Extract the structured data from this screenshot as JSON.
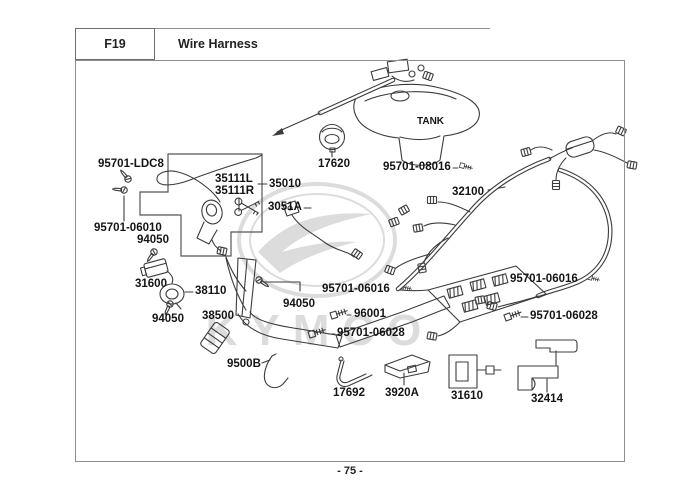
{
  "header": {
    "code": "F19",
    "title": "Wire Harness"
  },
  "footer": {
    "page_number": "- 75 -"
  },
  "watermark": {
    "brand": "KYMCO"
  },
  "diagram": {
    "tank_label": "TANK",
    "part_labels": [
      {
        "text": "95701-LDC8",
        "x": 98,
        "y": 159
      },
      {
        "text": "35111L",
        "x": 215,
        "y": 174
      },
      {
        "text": "35111R",
        "x": 215,
        "y": 186
      },
      {
        "text": "35010",
        "x": 269,
        "y": 179
      },
      {
        "text": "3051A",
        "x": 268,
        "y": 202
      },
      {
        "text": "17620",
        "x": 318,
        "y": 159
      },
      {
        "text": "95701-08016",
        "x": 383,
        "y": 162
      },
      {
        "text": "32100",
        "x": 452,
        "y": 187
      },
      {
        "text": "95701-06010",
        "x": 94,
        "y": 223
      },
      {
        "text": "94050",
        "x": 137,
        "y": 235
      },
      {
        "text": "31600",
        "x": 135,
        "y": 279
      },
      {
        "text": "38110",
        "x": 195,
        "y": 286
      },
      {
        "text": "94050",
        "x": 152,
        "y": 314
      },
      {
        "text": "38500",
        "x": 202,
        "y": 311
      },
      {
        "text": "9500B",
        "x": 227,
        "y": 359
      },
      {
        "text": "94050",
        "x": 283,
        "y": 299
      },
      {
        "text": "95701-06016",
        "x": 322,
        "y": 284
      },
      {
        "text": "96001",
        "x": 354,
        "y": 309
      },
      {
        "text": "95701-06028",
        "x": 337,
        "y": 328
      },
      {
        "text": "95701-06016",
        "x": 510,
        "y": 274
      },
      {
        "text": "95701-06028",
        "x": 530,
        "y": 311
      },
      {
        "text": "17692",
        "x": 333,
        "y": 388
      },
      {
        "text": "3920A",
        "x": 385,
        "y": 388
      },
      {
        "text": "31610",
        "x": 451,
        "y": 391
      },
      {
        "text": "32414",
        "x": 531,
        "y": 394
      }
    ]
  }
}
